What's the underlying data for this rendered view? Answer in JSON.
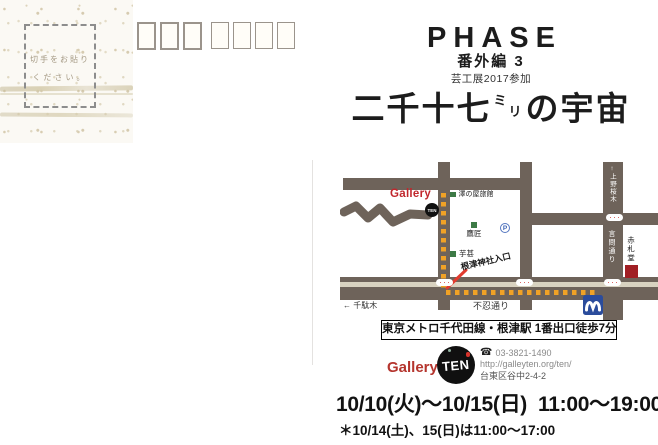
{
  "stamp": {
    "line1": "切手をお貼り",
    "line2": "ください。"
  },
  "header": {
    "title": "PHASE",
    "edition": "番外編 3",
    "participation": "芸工展2017参加",
    "main_title": {
      "pre": "二千十七",
      "small_top": "ミ",
      "small_bottom": "リ",
      "post": "の宇宙"
    }
  },
  "map": {
    "labels": {
      "gallery": "Gallery",
      "gallery_logo": "TEN",
      "sawanoya": "澤の屋旅館",
      "takajo": "鷹匠",
      "parking": "P",
      "imojin": "芋甚",
      "nezu_shrine": "根津神社入口",
      "sendagi": "← 千駄木",
      "shinobazu": "不忍通り",
      "ueno_sakuragi": "↑上野桜木",
      "kototoi": "言問通り",
      "akafudado": "赤札堂"
    }
  },
  "access": {
    "station": "東京メトロ千代田線・根津駅 1番出口徒歩7分"
  },
  "contact": {
    "gallery": "Gallery",
    "logo": "TEN",
    "phone_icon": "☎",
    "phone": "03-3821-1490",
    "url": "http://galleyten.org/ten/",
    "address": "台東区谷中2-4-2"
  },
  "schedule": {
    "dates": "10/10(火)〜10/15(日)  11:00〜19:00",
    "note": "＊10/14(土)、15(日)は11:00〜17:00"
  },
  "colors": {
    "street": "#6e635a",
    "route_orange": "#f0a226",
    "median_beige": "#d8d2c0",
    "metro_blue": "#2b4c9c",
    "gallery_red": "#c1272d",
    "landmark_green": "#3d7a46",
    "akafudado_red": "#a11f24",
    "signal_red": "#d03a34"
  }
}
